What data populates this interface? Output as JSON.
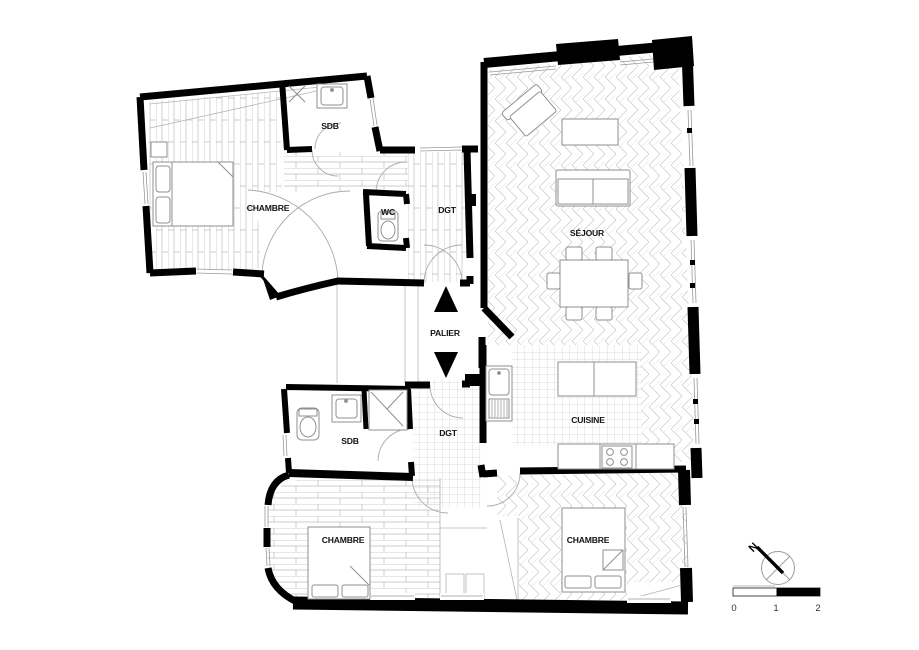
{
  "rooms": [
    {
      "id": "chambre-nw",
      "label": "CHAMBRE"
    },
    {
      "id": "sdb-north",
      "label": "SDB"
    },
    {
      "id": "wc",
      "label": "WC"
    },
    {
      "id": "dgt-north",
      "label": "DGT"
    },
    {
      "id": "palier",
      "label": "PALIER"
    },
    {
      "id": "sejour",
      "label": "SÉJOUR"
    },
    {
      "id": "cuisine",
      "label": "CUISINE"
    },
    {
      "id": "sdb-south",
      "label": "SDB"
    },
    {
      "id": "dgt-south",
      "label": "DGT"
    },
    {
      "id": "chambre-sw",
      "label": "CHAMBRE"
    },
    {
      "id": "chambre-se",
      "label": "CHAMBRE"
    }
  ],
  "compass": {
    "label": "N"
  },
  "scale_bar": {
    "labels": [
      "0",
      "1",
      "2"
    ]
  },
  "colors": {
    "wall": "#000000",
    "floor_line": "#bdbdbd",
    "furniture_line": "#8f8f8f",
    "door_arc": "#aaaaaa"
  }
}
